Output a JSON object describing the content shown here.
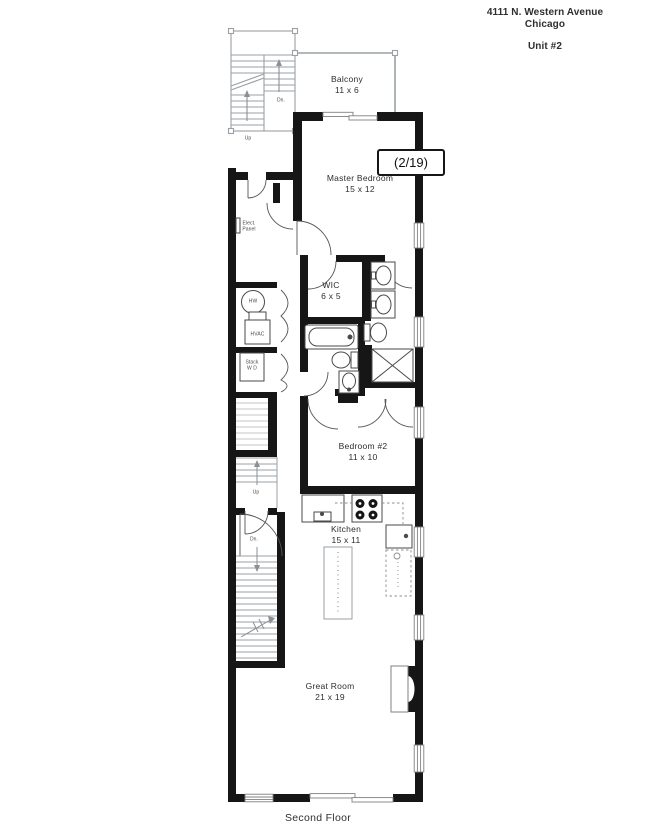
{
  "header": {
    "address_line1": "4111 N. Western Avenue",
    "address_line2": "Chicago",
    "unit": "Unit #2"
  },
  "page_indicator": "(2/19)",
  "floor_label": "Second Floor",
  "rooms": {
    "balcony": {
      "name": "Balcony",
      "dims": "11 x 6"
    },
    "master_bedroom": {
      "name": "Master Bedroom",
      "dims": "15 x 12"
    },
    "wic": {
      "name": "WIC",
      "dims": "6 x 5"
    },
    "bedroom_2": {
      "name": "Bedroom #2",
      "dims": "11 x 10"
    },
    "kitchen": {
      "name": "Kitchen",
      "dims": "15 x 11"
    },
    "great_room": {
      "name": "Great Room",
      "dims": "21 x 19"
    }
  },
  "annotations": {
    "elect_panel_line1": "Elect.",
    "elect_panel_line2": "Panel",
    "hw": "HW",
    "hvac": "HVAC",
    "stack_wd_line1": "Stack",
    "stack_wd_line2": "W D",
    "down_abbrev": "Dn.",
    "up_abbrev": "Up"
  },
  "colors": {
    "wall": "#161616",
    "stair_gray": "#9aa0a4",
    "light_stair_gray": "#c6c6c6",
    "fixture_gray": "#4a4a4a",
    "text": "#2f2f2f"
  }
}
